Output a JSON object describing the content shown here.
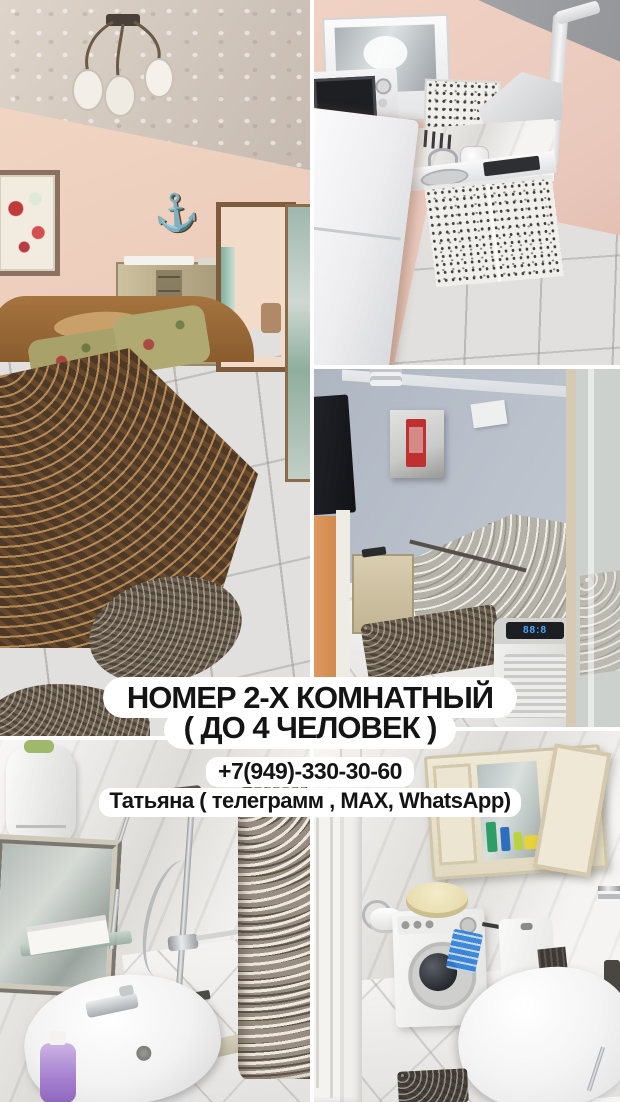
{
  "overlay": {
    "title_line1": "НОМЕР 2-Х КОМНАТНЫЙ",
    "title_line2": "( ДО 4 ЧЕЛОВЕК )",
    "phone": "+7(949)-330-30-60",
    "contact": "Татьяна ( телеграмм , MAX, WhatsApp)",
    "text_color": "#141414",
    "pill_background": "#ffffff"
  },
  "collage": {
    "background": "#ffffff",
    "photos": [
      {
        "name": "bedroom-main",
        "position": "top-left"
      },
      {
        "name": "kitchen",
        "position": "top-right"
      },
      {
        "name": "small-bedroom",
        "position": "middle-right"
      },
      {
        "name": "bathroom-shower",
        "position": "bottom-left"
      },
      {
        "name": "bathroom-toilet-washer",
        "position": "bottom-right"
      }
    ]
  },
  "palette": {
    "bedroom_wall": "#ecccba",
    "kitchen_wall": "#eac9bd",
    "small_bedroom_wall": "#b7bfc9",
    "bathroom_marble": "#eceae7",
    "bedspread_brown": "#4e3926",
    "floor_tile_gray": "#e1e0de",
    "cabinet_cream": "#e9e2cf"
  }
}
